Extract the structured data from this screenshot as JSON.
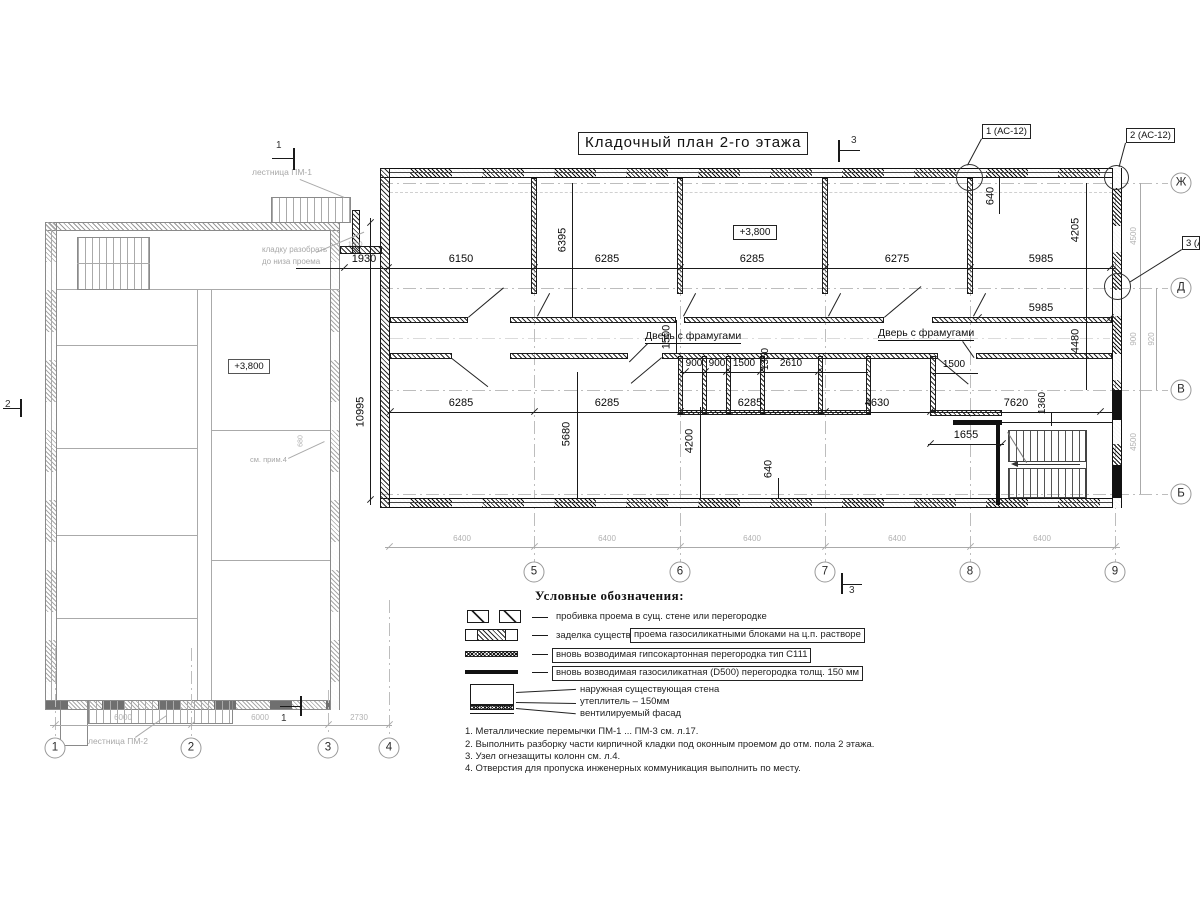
{
  "title": "Кладочный план 2-го этажа",
  "callouts": [
    "1 (АС-12)",
    "2 (АС-12)",
    "3 (АС-12"
  ],
  "levels": {
    "main": "+3,800",
    "left": "+3,800"
  },
  "door_label": "Дверь с фрамугами",
  "axes": {
    "right": [
      "Ж",
      "Д",
      "В",
      "Б"
    ],
    "bottom_main": [
      "5",
      "6",
      "7",
      "8",
      "9"
    ],
    "bottom_left": [
      "1",
      "2",
      "3",
      "4"
    ]
  },
  "section_marks": {
    "s1": "1",
    "s2": "2",
    "s3": "3"
  },
  "dims": {
    "top": [
      "1930",
      "6150",
      "6285",
      "6285",
      "6275",
      "5985"
    ],
    "row2": [
      "5985"
    ],
    "bottom": [
      "6285",
      "6285",
      "6285",
      "4630",
      "7620"
    ],
    "extra": [
      "1655"
    ],
    "mid": [
      "900",
      "900",
      "1500",
      "2610",
      "1500"
    ],
    "vert": [
      "6395",
      "1500",
      "10995",
      "5680",
      "4200",
      "640",
      "1350",
      "1360",
      "640",
      "4205",
      "4480"
    ],
    "grid_main": [
      "6400",
      "6400",
      "6400",
      "6400",
      "6400"
    ],
    "grid_left": [
      "6000",
      "6000",
      "2730"
    ],
    "right_outer": [
      "4500",
      "900",
      "920",
      "4500"
    ],
    "tiny": [
      "1000",
      "680"
    ]
  },
  "annotations": {
    "stair1": "лестница ПМ-1",
    "stair2": "лестница ПМ-2",
    "demolish_line1": "кладку разобрать",
    "demolish_line2": "до низа проема",
    "see_note": "см. прим.4"
  },
  "legend": {
    "header": "Условные обозначения:",
    "item1": "пробивка проема  в сущ. стене  или перегородке",
    "item2_plain": "заделка существ.",
    "item2_boxed": "проема газосиликатными блоками на ц.п. растворе",
    "item3_boxed": "вновь возводимая гипсокартонная перегородка тип С111",
    "item4_boxed": "вновь возводимая газосиликатная (D500) перегородка толщ. 150 мм",
    "item5_lines": [
      "наружная существующая стена",
      "утеплитель  –  150мм",
      "вентилируемый фасад"
    ]
  },
  "notes": [
    "1. Металлические перемычки  ПМ-1 ... ПМ-3 см. л.17.",
    "2. Выполнить разборку части кирпичной кладки под оконным проемом до отм. пола 2 этажа.",
    "3. Узел огнезащиты колонн см. л.4.",
    "4. Отверстия для пропуска инженерных коммуникация выполнить по месту."
  ]
}
